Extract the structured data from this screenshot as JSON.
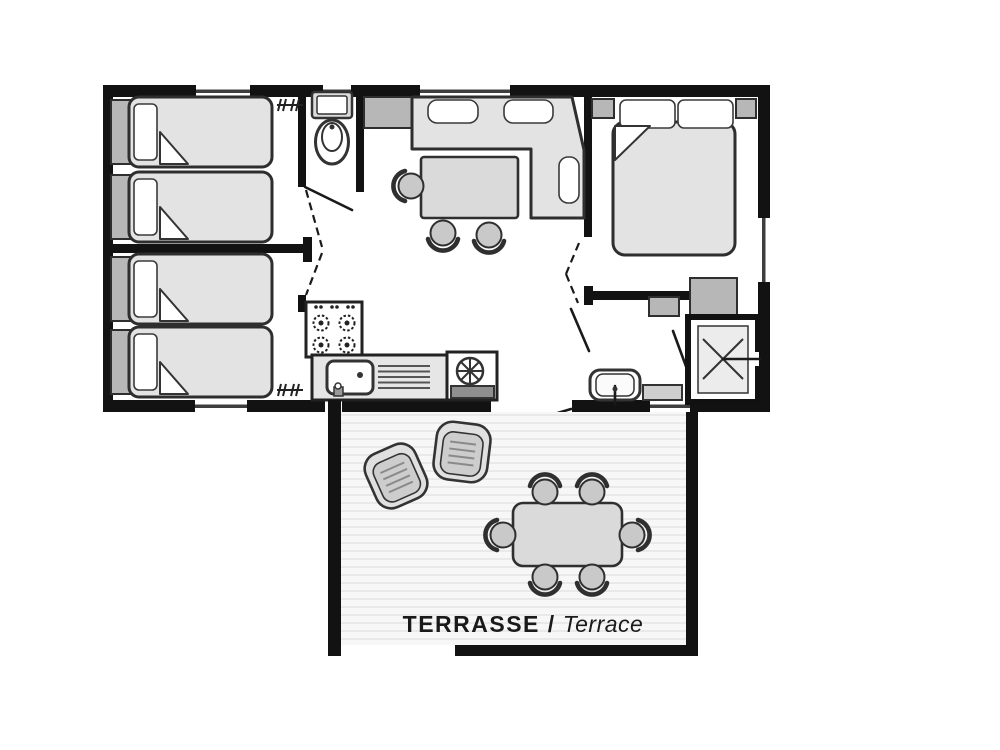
{
  "terrace_label": {
    "bold": "TERRASSE /",
    "italic": "Terrace"
  },
  "colors": {
    "wall": "#121212",
    "outline": "#2e2e2e",
    "fill_light": "#e3e3e3",
    "fill_mid": "#b7b7b7",
    "fill_dark": "#8f8f8f",
    "paper": "#ffffff",
    "deck_bg": "#f7f7f7",
    "deck_stripe": "#e9e9e9",
    "label": "#1a1a1a"
  },
  "legend": {
    "rooms": [
      "bedroom-two-single-beds",
      "bedroom-two-single-beds",
      "wc",
      "kitchen",
      "living-dining",
      "master-bedroom",
      "shower-room",
      "terrace"
    ],
    "furniture_counts": {
      "single_beds": 4,
      "double_beds": 1,
      "indoor_dining_chairs": 3,
      "terrace_dining_chairs": 6,
      "terrace_lounge_chairs": 2,
      "stove_burners": 4
    }
  }
}
